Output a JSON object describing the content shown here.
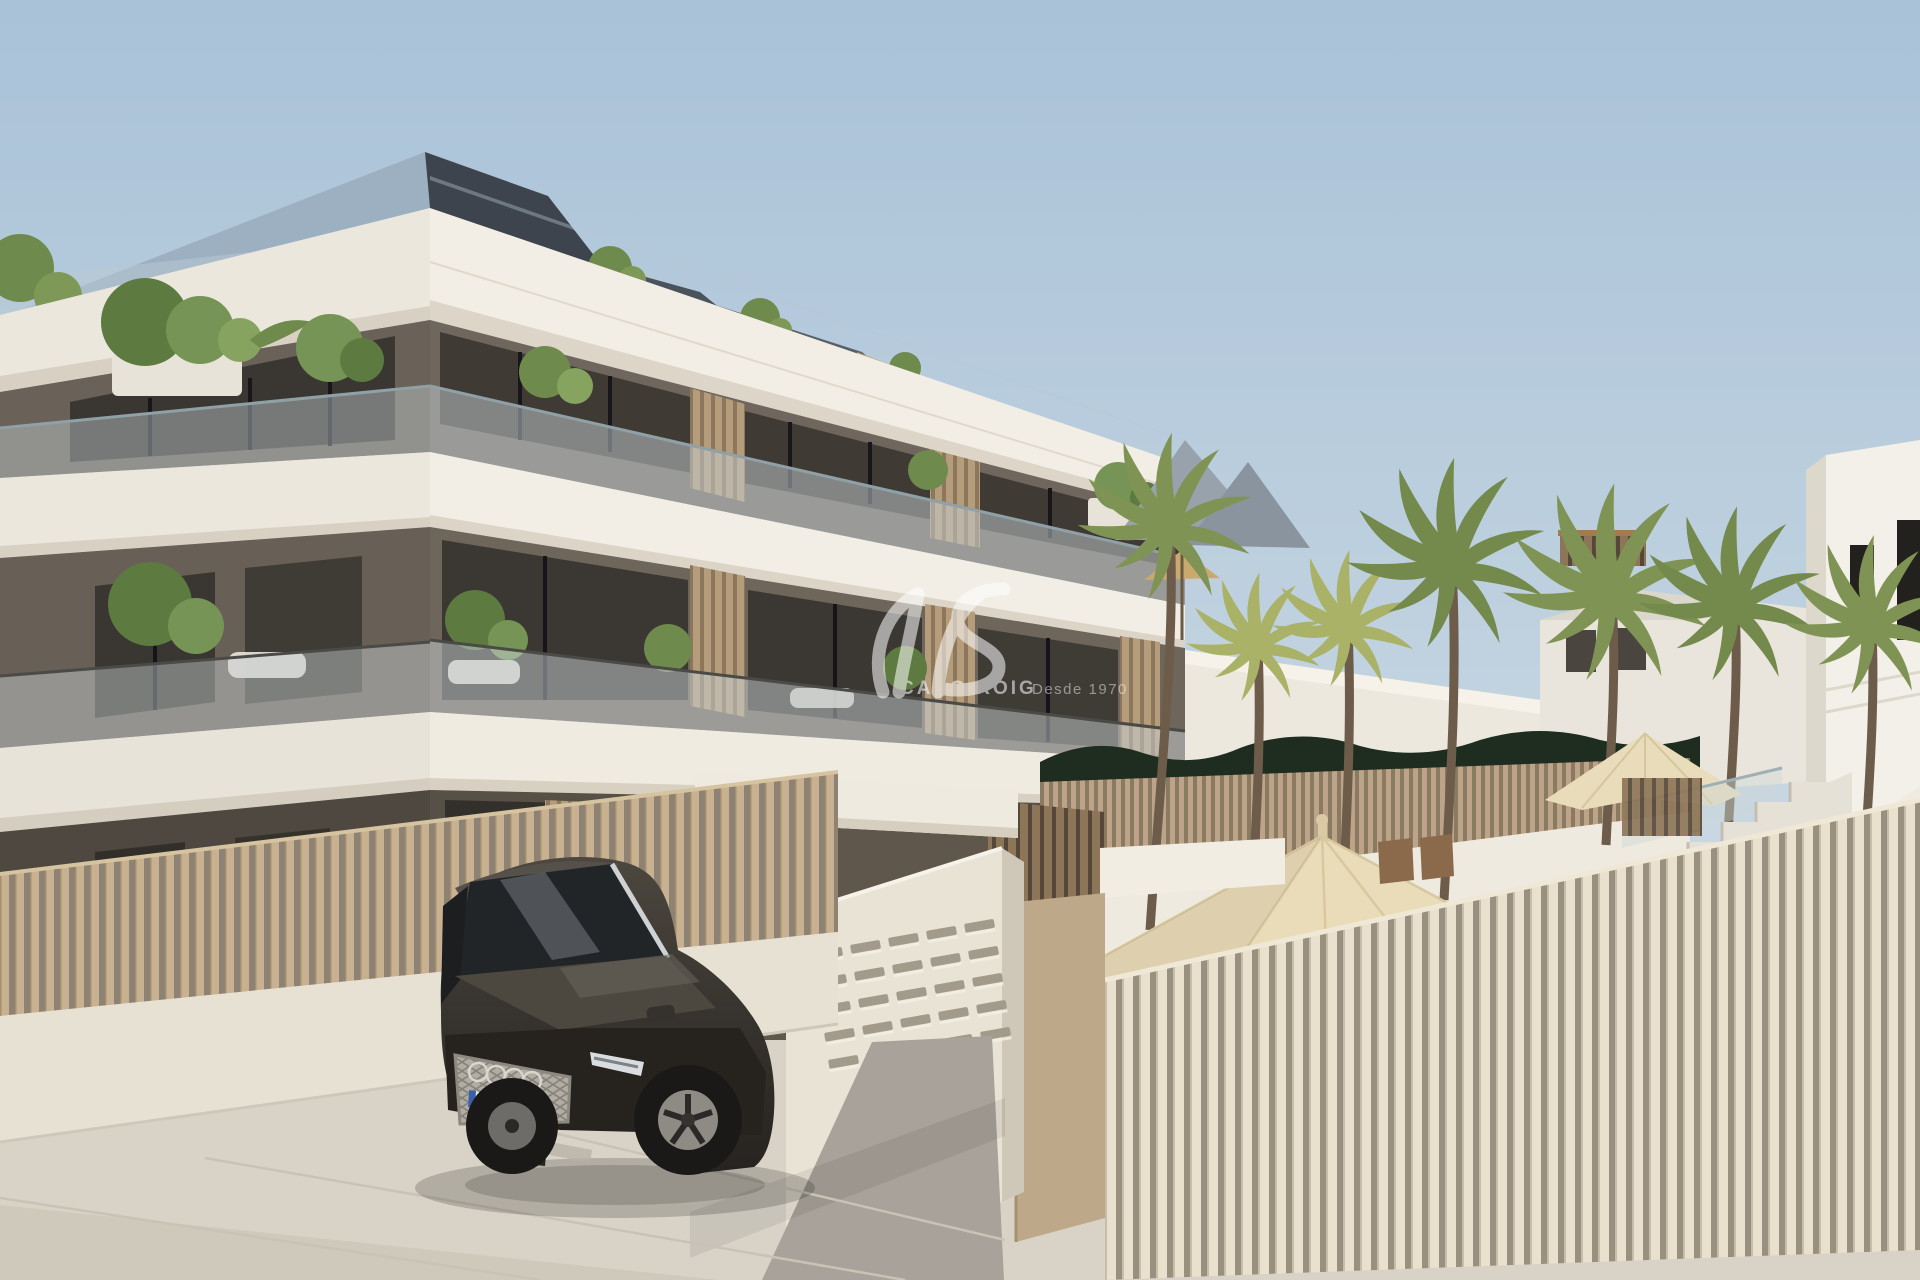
{
  "watermark": {
    "logo_icon": "wave-swoosh-logo",
    "brand": "CABO ROIG",
    "tagline": "Desde 1970",
    "color": "#ffffff",
    "opacity": 0.55
  },
  "mailboxes": {
    "rows": 5,
    "cols": 5
  },
  "palette": {
    "sky_top": "#a9c2d8",
    "sky_horizon": "#dde6ec",
    "facade_white": "#f2eee5",
    "facade_shadow": "#d8d1c3",
    "wall_dark": "#564f46",
    "wall_taupe": "#6e655b",
    "window_dark": "#33302b",
    "glass_railing": "#c7d1d4",
    "wood_slat_screen": "#b49a78",
    "fence_beige": "#c7b190",
    "fence_cream": "#e9e0ce",
    "pool_fence_tan": "#bda387",
    "pavement": "#d9d3c7",
    "driveway_grey": "#a8a29a",
    "hedge_green": "#1e2d20",
    "grass_green": "#9aa06b",
    "palm_green": "#7f9454",
    "palm_yellow": "#a9b266",
    "umbrella_cream": "#eadcb8",
    "car_body": "#37332e",
    "roof_dark": "#3d444d"
  },
  "scene": {
    "objects": [
      "apartment-building",
      "penthouse-roof",
      "balcony-glass-railings",
      "wood-slat-screens",
      "beige-slat-fence",
      "entrance-gate",
      "letterbox-pillar",
      "audi-suv",
      "license-plate",
      "palm-trees",
      "pool-hedge",
      "sun-loungers",
      "patio-umbrellas",
      "outdoor-dining-chairs",
      "outdoor-sofa",
      "white-staircase",
      "neighbor-houses"
    ]
  }
}
